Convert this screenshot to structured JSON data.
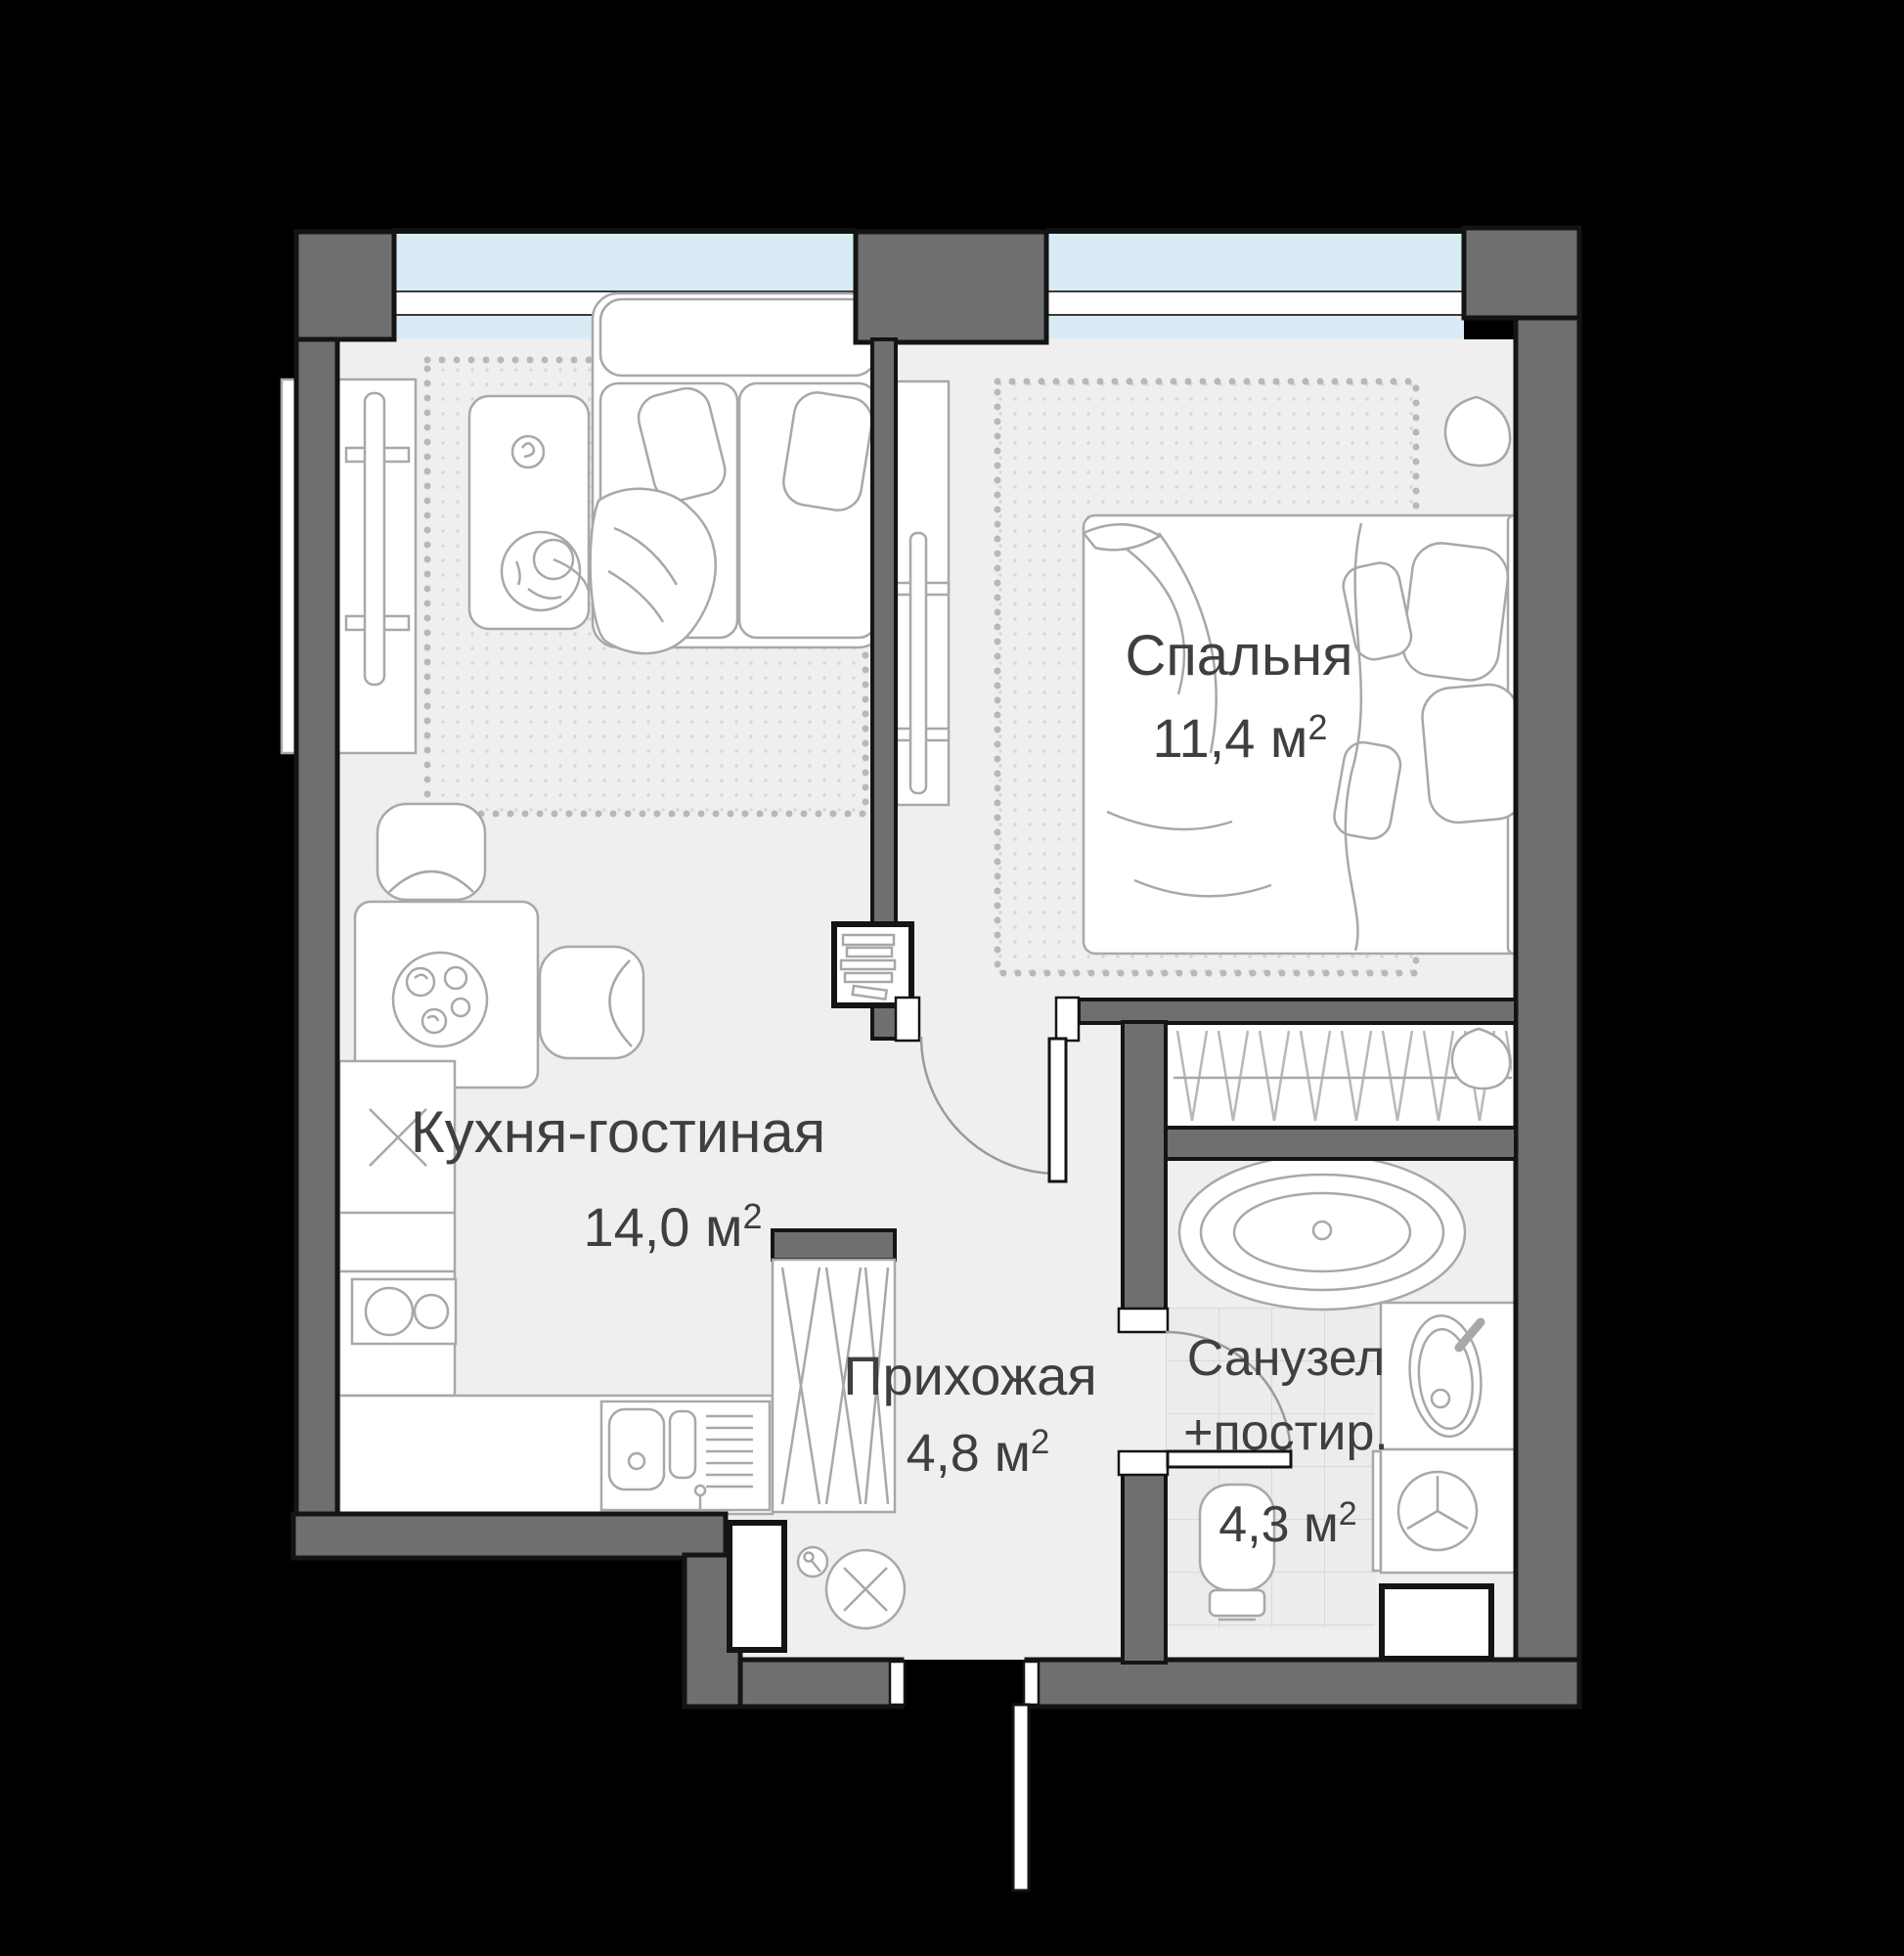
{
  "plan": {
    "type": "apartment-floor-plan",
    "language": "ru",
    "rooms": {
      "bedroom": {
        "name": "Спальня",
        "area": "11,4 м",
        "sup": "2"
      },
      "kitchen_living": {
        "name": "Кухня-гостиная",
        "area": "14,0 м",
        "sup": "2"
      },
      "hallway": {
        "name": "Прихожая",
        "area": "4,8 м",
        "sup": "2"
      },
      "bathroom": {
        "name": "Санузел",
        "name2": "+постир.",
        "area": "4,3 м",
        "sup": "2"
      }
    },
    "colors": {
      "background": "#000000",
      "wall": "#6f6f6f",
      "wall_outline": "#141414",
      "floor": "#efefef",
      "window_glass": "#d9ecf5",
      "furniture_stroke": "#a8a8a8",
      "tile": "#ececec",
      "label": "#3f3f3f"
    }
  }
}
